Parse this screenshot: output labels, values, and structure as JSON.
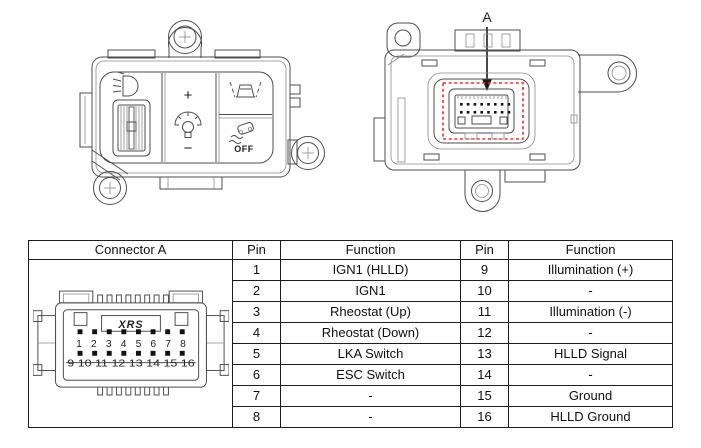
{
  "figures": {
    "front_view": {
      "description": "switch module front view",
      "icons": [
        "headlight-leveling-icon",
        "rheostat-dimmer-icon",
        "lka-switch-icon",
        "esc-off-switch-icon"
      ],
      "rheostat_plus": "+",
      "rheostat_minus": "−",
      "esc_off_label": "OFF"
    },
    "rear_view": {
      "description": "switch module rear view with connector",
      "connector_callout": "A"
    }
  },
  "connector_drawing": {
    "brand_label": "XRS",
    "pin_numbers_top": "1 2 3 4 5 6 7 8",
    "pin_numbers_bottom": "9 10 11 12 13 14 15 16"
  },
  "table": {
    "headers": {
      "connector": "Connector A",
      "pin_left": "Pin",
      "function_left": "Function",
      "pin_right": "Pin",
      "function_right": "Function"
    },
    "rows": [
      {
        "pin_left": "1",
        "function_left": "IGN1 (HLLD)",
        "pin_right": "9",
        "function_right": "Illumination (+)"
      },
      {
        "pin_left": "2",
        "function_left": "IGN1",
        "pin_right": "10",
        "function_right": "-"
      },
      {
        "pin_left": "3",
        "function_left": "Rheostat (Up)",
        "pin_right": "11",
        "function_right": "Illumination (-)"
      },
      {
        "pin_left": "4",
        "function_left": "Rheostat (Down)",
        "pin_right": "12",
        "function_right": "-"
      },
      {
        "pin_left": "5",
        "function_left": "LKA Switch",
        "pin_right": "13",
        "function_right": "HLLD Signal"
      },
      {
        "pin_left": "6",
        "function_left": "ESC Switch",
        "pin_right": "14",
        "function_right": "-"
      },
      {
        "pin_left": "7",
        "function_left": "-",
        "pin_right": "15",
        "function_right": "Ground"
      },
      {
        "pin_left": "8",
        "function_left": "-",
        "pin_right": "16",
        "function_right": "HLLD Ground"
      }
    ]
  },
  "colors": {
    "highlight": "#e53430",
    "line": "#4d4d4d",
    "table_border": "#1d1d1d"
  }
}
